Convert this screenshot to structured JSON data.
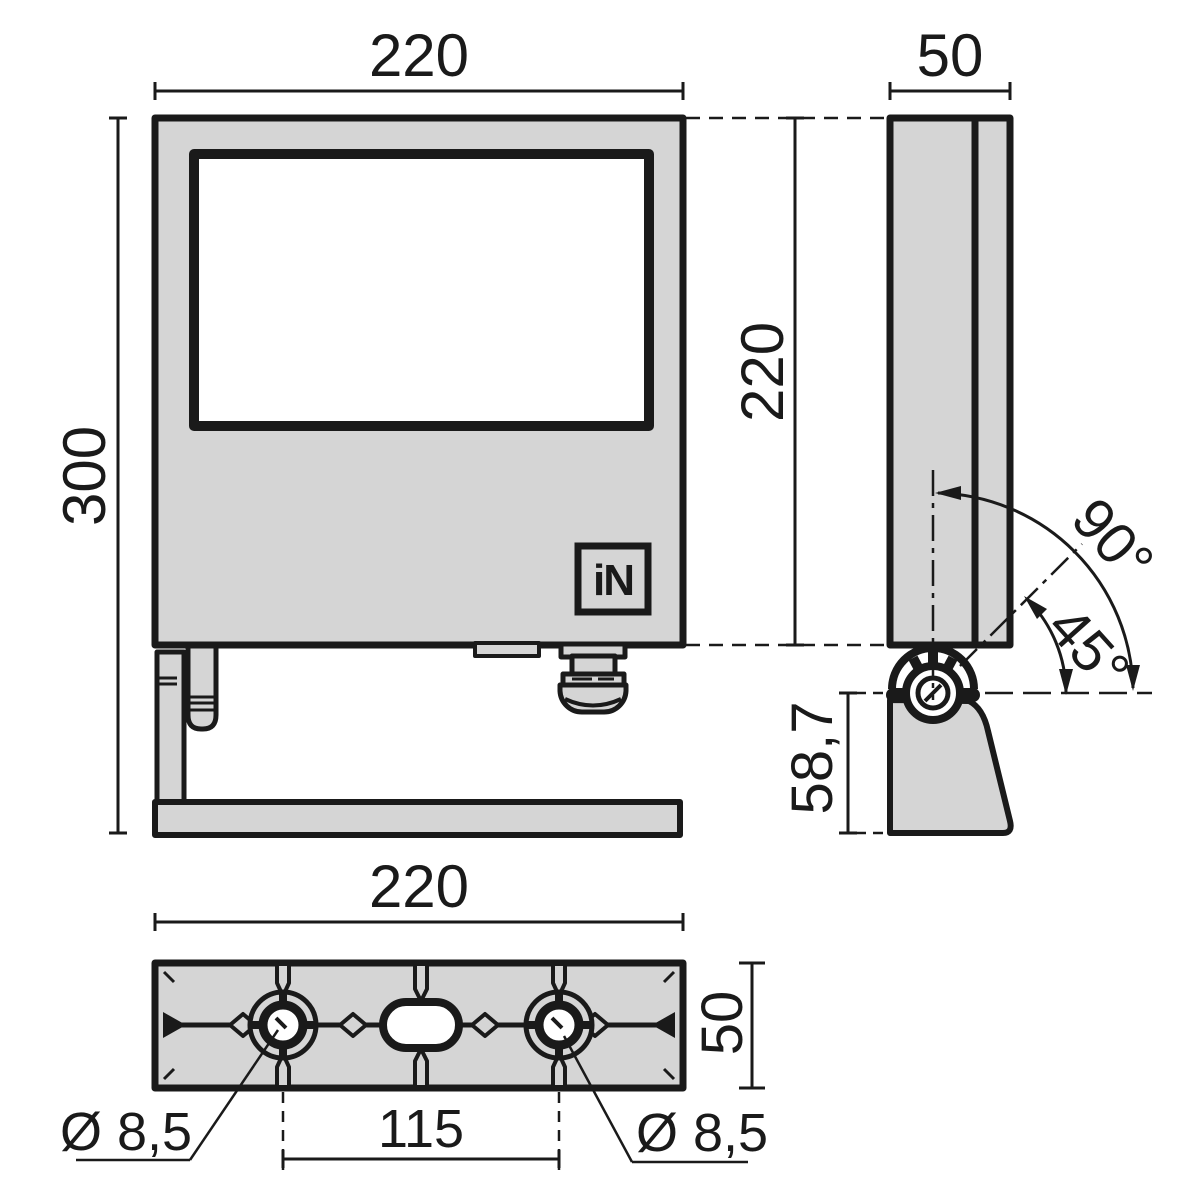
{
  "drawing": {
    "colors": {
      "line": "#1a1a1a",
      "fill": "#d5d5d5",
      "background": "#ffffff"
    },
    "logo": {
      "text": "iN"
    },
    "front_view": {
      "width_label": "220",
      "height_label": "300"
    },
    "side_view": {
      "depth_label": "50",
      "body_height_label": "220",
      "angle_full_label": "90°",
      "angle_half_label": "45°",
      "pivot_offset_label": "58,7"
    },
    "bottom_view": {
      "width_label": "220",
      "depth_label": "50",
      "hole_spacing_label": "115",
      "hole_diameter_left_label": "Ø 8,5",
      "hole_diameter_right_label": "Ø 8,5"
    }
  }
}
